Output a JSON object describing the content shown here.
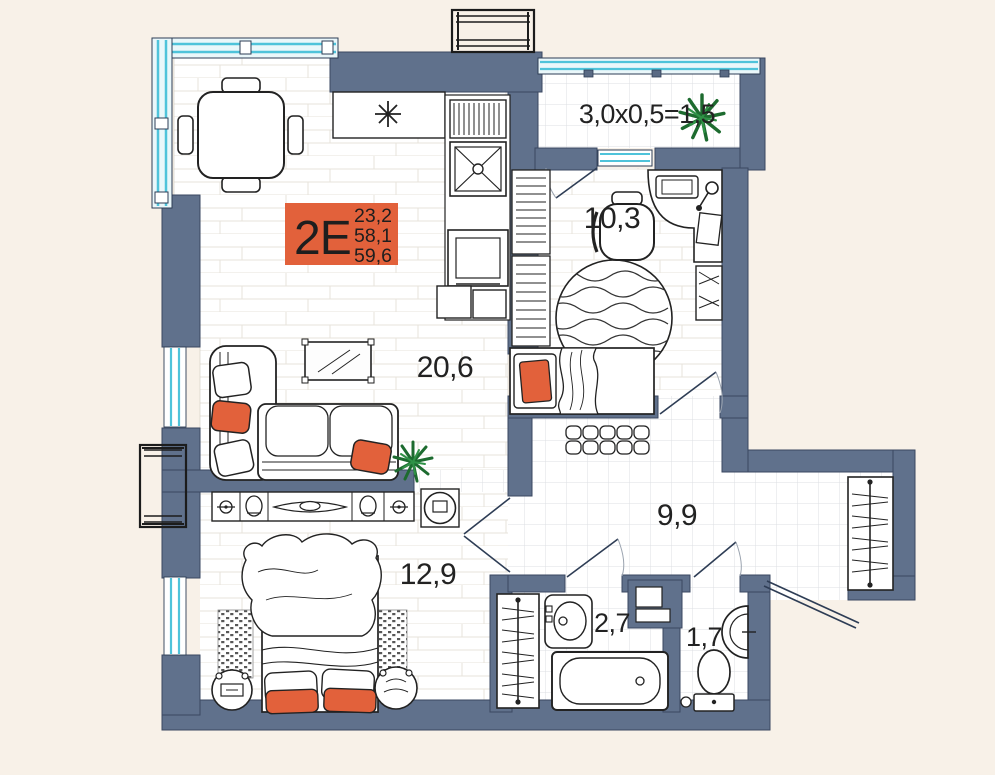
{
  "unit_card": {
    "type_label": "2E",
    "area_values": [
      "23,2",
      "58,1",
      "59,6"
    ]
  },
  "room_labels": {
    "balcony": "3,0x0,5=1,5",
    "bedroom_small": "10,3",
    "living_kitchen": "20,6",
    "hallway": "9,9",
    "bedroom_master": "12,9",
    "bathroom": "2,7",
    "wc": "1,7"
  },
  "colors": {
    "accent_orange": "#e2613b",
    "wall_slate": "#60718c",
    "window_cyan": "#4fc3da",
    "plant_green": "#1d6b2f",
    "background_beige": "#f8f1e8"
  }
}
